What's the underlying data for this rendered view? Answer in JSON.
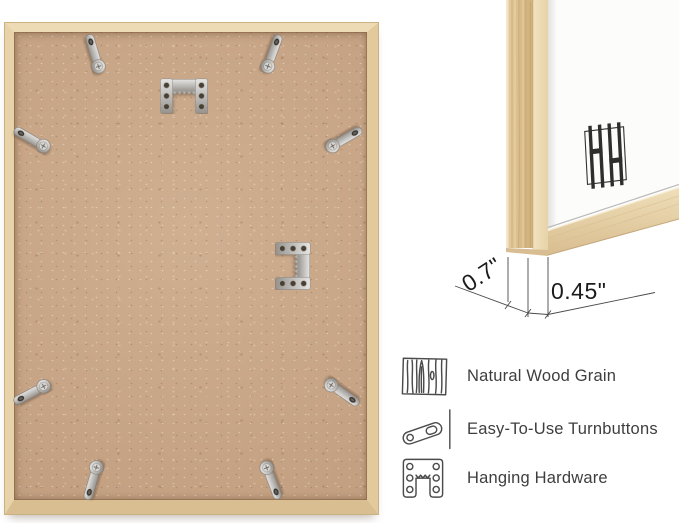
{
  "back_view": {
    "name": "frame-back-photo",
    "hardware": {
      "turnbutton_count": 8,
      "sawtooth_hanger_count": 2
    }
  },
  "corner_detail": {
    "name": "frame-corner-photo",
    "brand_logo": "hh-monogram",
    "dimensions": {
      "depth_label": "0.7\"",
      "face_label": "0.45\""
    }
  },
  "features": {
    "items": [
      {
        "icon": "wood-grain-icon",
        "label": "Natural Wood Grain"
      },
      {
        "icon": "turnbutton-icon",
        "label": "Easy-To-Use Turnbuttons"
      },
      {
        "icon": "hanging-hardware-icon",
        "label": "Hanging Hardware"
      }
    ]
  },
  "colors": {
    "background": "#ffffff",
    "backing_board": "#c7a485",
    "frame_wood": "#e7d0a7",
    "metal_hardware": "#c3c1be",
    "label_text": "#3e3e3e",
    "dimension_text": "#1b1b1b"
  }
}
